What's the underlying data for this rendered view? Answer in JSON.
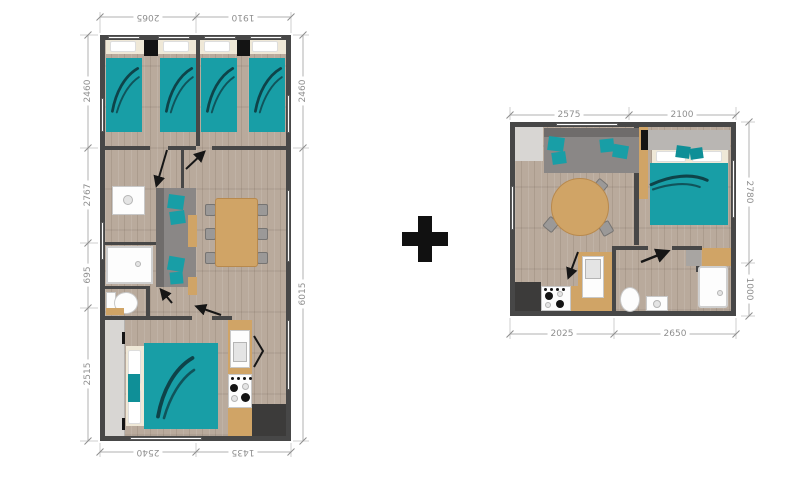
{
  "separator": {
    "plus_symbol": "+"
  },
  "left_plan": {
    "dims_top": [
      "2065",
      "1910"
    ],
    "dims_left": [
      "2460",
      "2767",
      "695",
      "2515"
    ],
    "dims_right": [
      "2460",
      "6015"
    ],
    "dims_bottom": [
      "2540",
      "1435"
    ]
  },
  "right_plan": {
    "dims_top": [
      "2575",
      "2100"
    ],
    "dims_right": [
      "2780",
      "1000"
    ],
    "dims_bottom": [
      "2025",
      "2650"
    ]
  },
  "colors": {
    "accent_teal": "#189ea6",
    "wood_tan": "#d0a466",
    "wall_gray": "#474747",
    "sofa_gray": "#8a8786",
    "dimension_text": "#8f8f8f"
  }
}
